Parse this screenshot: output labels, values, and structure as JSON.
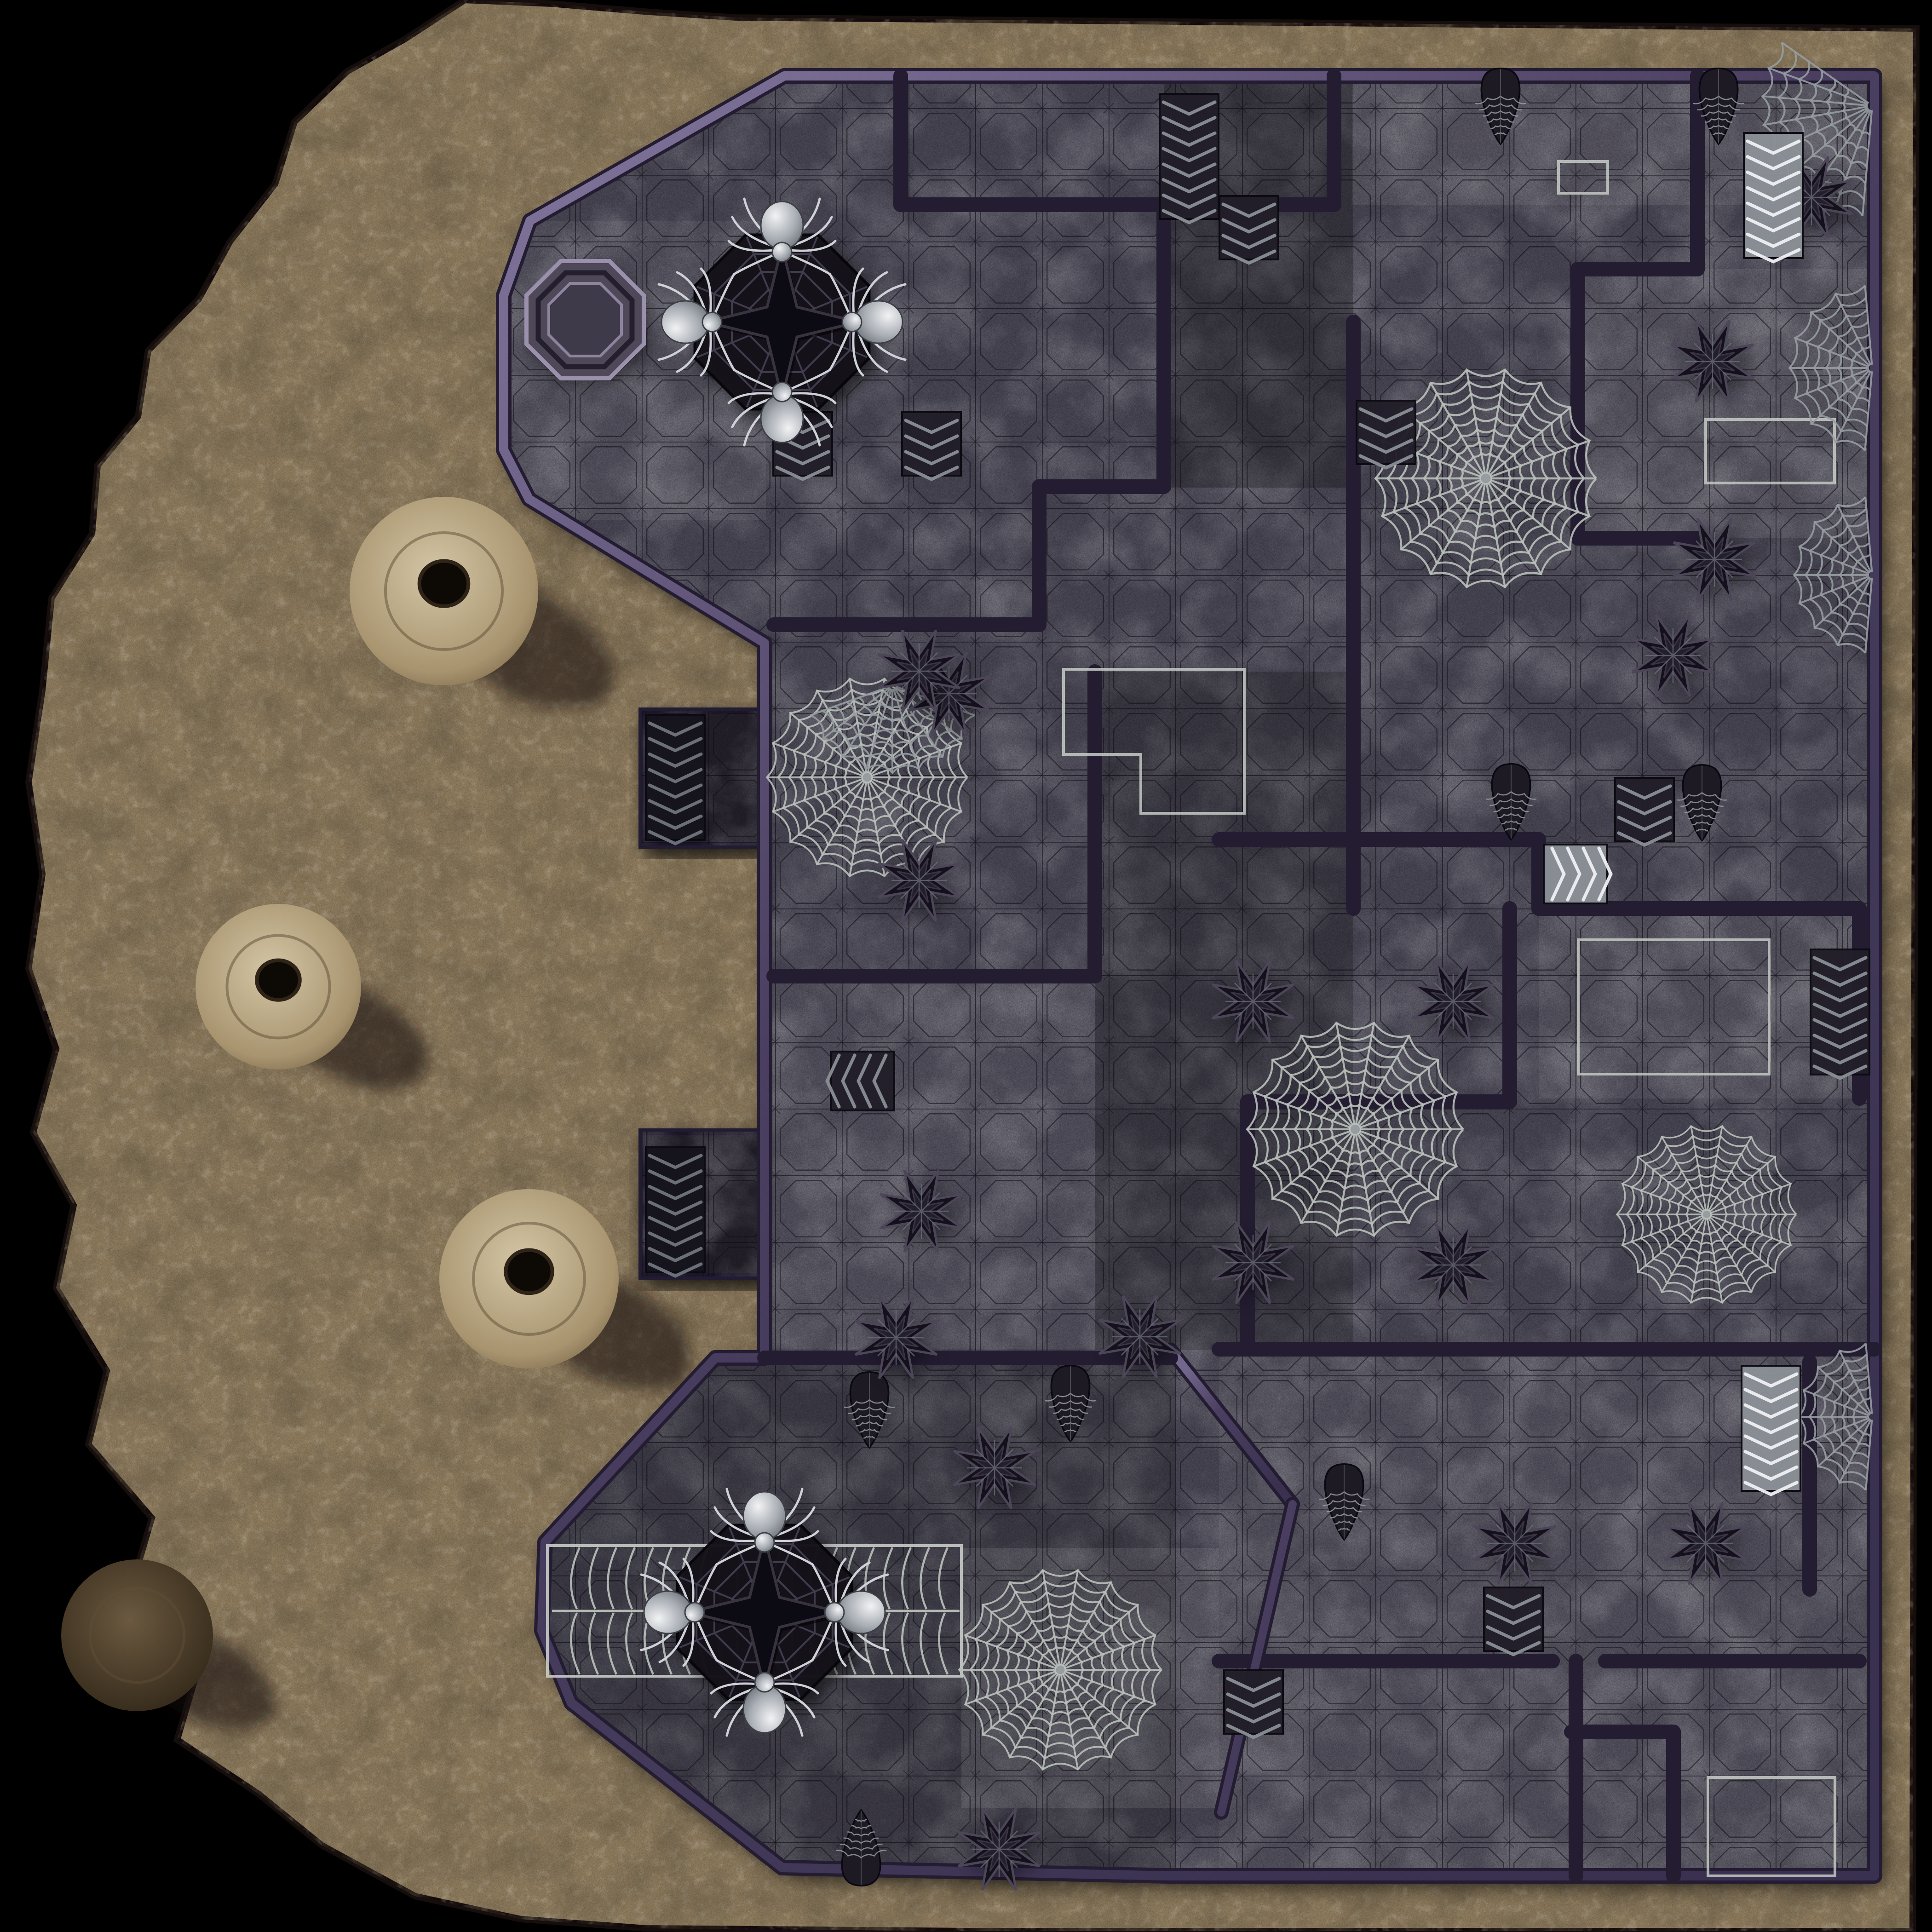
{
  "meta": {
    "name": "spider-dungeon-battle-map",
    "kind": "tabletop-battle-map"
  },
  "palette": {
    "bg": "#000000",
    "sand": "#a18c6a",
    "sandLight": "#d8c8a6",
    "sandDark": "#2e2314",
    "sandEdge": "#120d07",
    "floor": "#575263",
    "floorLight": "#746d7e",
    "floorDark": "#36323e",
    "wallDark": "#241d32",
    "wallMid": "#4a3f60",
    "wallSheenA": "#8478a0",
    "wallSheenB": "#3a3150",
    "grid": "#0d0a12",
    "tileCarve": "#14101c",
    "web": "#b9c0ba",
    "webDim": "#969ca0",
    "marker": "#c6cbc6",
    "spiderBody": "#dfe2e5",
    "spiderMid": "#a7acb3",
    "spiderDark": "#5c6168",
    "objectDark": "#14111b",
    "objectEdge": "#4c4658",
    "stairLightBase": "#8b9097",
    "stairLightRidge": "#eef0f3",
    "stairDarkBase": "#211e29",
    "stairDarkRidge": "#8a8f96",
    "stairBlackBase": "#15131c",
    "stairBlackRidge": "#6f747d",
    "wellRimLight": "#9b91ad",
    "wellRimDark": "#241f2e",
    "wellBasin": "#3f3a4a"
  },
  "grid": {
    "size": 145,
    "offset": 90
  },
  "cave": {
    "outline": [
      [
        1010,
        0
      ],
      [
        880,
        85
      ],
      [
        755,
        155
      ],
      [
        640,
        265
      ],
      [
        598,
        400
      ],
      [
        500,
        525
      ],
      [
        432,
        650
      ],
      [
        322,
        762
      ],
      [
        300,
        905
      ],
      [
        212,
        1012
      ],
      [
        200,
        1160
      ],
      [
        112,
        1300
      ],
      [
        92,
        1500
      ],
      [
        62,
        1700
      ],
      [
        92,
        1900
      ],
      [
        62,
        2105
      ],
      [
        122,
        2280
      ],
      [
        72,
        2462
      ],
      [
        160,
        2620
      ],
      [
        122,
        2800
      ],
      [
        232,
        2980
      ],
      [
        192,
        3140
      ],
      [
        330,
        3300
      ],
      [
        282,
        3462
      ],
      [
        432,
        3622
      ],
      [
        385,
        3782
      ],
      [
        562,
        3900
      ],
      [
        700,
        4012
      ],
      [
        902,
        4122
      ],
      [
        1132,
        4172
      ],
      [
        1402,
        4192
      ],
      [
        2100,
        4198
      ],
      [
        4158,
        4198
      ],
      [
        4166,
        62
      ],
      [
        1600,
        38
      ],
      [
        1400,
        25
      ],
      [
        1200,
        8
      ]
    ],
    "mounds": [
      {
        "x": 965,
        "y": 1285,
        "r": 205,
        "variant": "sand"
      },
      {
        "x": 605,
        "y": 2145,
        "r": 180,
        "variant": "sand"
      },
      {
        "x": 1150,
        "y": 2780,
        "r": 195,
        "variant": "sand"
      },
      {
        "x": 298,
        "y": 3555,
        "r": 165,
        "variant": "dark"
      }
    ]
  },
  "map": {
    "outline": [
      [
        1705,
        165
      ],
      [
        4075,
        165
      ],
      [
        4075,
        4078
      ],
      [
        2545,
        4078
      ],
      [
        1700,
        4060
      ],
      [
        1242,
        3702
      ],
      [
        1178,
        3545
      ],
      [
        1185,
        3352
      ],
      [
        1555,
        2952
      ],
      [
        1662,
        2952
      ],
      [
        1662,
        1398
      ],
      [
        1150,
        1085
      ],
      [
        1095,
        978
      ],
      [
        1095,
        642
      ],
      [
        1152,
        480
      ]
    ],
    "pads": [
      [
        1395,
        1545,
        268,
        293
      ],
      [
        1395,
        2460,
        268,
        315
      ]
    ],
    "walls": [
      [
        1958,
        165,
        1958,
        445
      ],
      [
        1958,
        445,
        2530,
        445
      ],
      [
        2530,
        445,
        2530,
        1058
      ],
      [
        2259,
        1058,
        2530,
        1058
      ],
      [
        2259,
        1058,
        2259,
        1358
      ],
      [
        1682,
        1358,
        2259,
        1358
      ],
      [
        2900,
        165,
        2900,
        445
      ],
      [
        2650,
        445,
        2900,
        445
      ],
      [
        2942,
        700,
        2942,
        1975
      ],
      [
        2650,
        1825,
        3345,
        1825
      ],
      [
        3345,
        1825,
        3345,
        1975
      ],
      [
        3345,
        1975,
        4042,
        1975
      ],
      [
        4042,
        1975,
        4042,
        2388
      ],
      [
        3282,
        1975,
        3282,
        2395
      ],
      [
        2712,
        2395,
        3282,
        2395
      ],
      [
        2712,
        2395,
        2712,
        2933
      ],
      [
        2380,
        1460,
        2380,
        2122
      ],
      [
        1682,
        2122,
        2380,
        2122
      ],
      [
        3430,
        585,
        3430,
        1170
      ],
      [
        3430,
        585,
        3690,
        585
      ],
      [
        3430,
        1170,
        3700,
        1170
      ],
      [
        3690,
        165,
        3690,
        585
      ],
      [
        2650,
        2933,
        4075,
        2933
      ],
      [
        2650,
        3611,
        3375,
        3611
      ],
      [
        3490,
        3611,
        4042,
        3611
      ],
      [
        3426,
        3611,
        3426,
        4078
      ],
      [
        3638,
        3765,
        3638,
        4078
      ],
      [
        3416,
        3765,
        3638,
        3765
      ],
      [
        3934,
        2960,
        3934,
        3455
      ],
      [
        2545,
        2935,
        2810,
        3270
      ],
      [
        2810,
        3270,
        2655,
        3940
      ],
      [
        1662,
        2952,
        2545,
        2952
      ]
    ],
    "shades": [
      [
        2530,
        165,
        412,
        895,
        "#000000",
        0.25
      ],
      [
        2380,
        1460,
        562,
        1475,
        "#000000",
        0.2
      ],
      [
        1175,
        2952,
        1380,
        1128,
        "#000000",
        0.16
      ],
      [
        2940,
        165,
        1130,
        280,
        "#ffffff",
        0.1
      ],
      [
        3430,
        585,
        640,
        585,
        "#ffffff",
        0.1
      ],
      [
        2090,
        3365,
        560,
        565,
        "#ffffff",
        0.12
      ],
      [
        2650,
        2933,
        1420,
        1148,
        "#ffffff",
        0.07
      ],
      [
        1095,
        480,
        570,
        650,
        "#ffffff",
        0.08
      ],
      [
        3345,
        1975,
        700,
        413,
        "#ffffff",
        0.09
      ],
      [
        1662,
        2122,
        718,
        810,
        "#ffffff",
        0.07
      ]
    ],
    "zones": {
      "rects": [
        [
          3708,
          912,
          280,
          138
        ],
        [
          3431,
          2043,
          415,
          292
        ],
        [
          3713,
          3864,
          276,
          214
        ],
        [
          3388,
          351,
          107,
          69
        ]
      ],
      "polys": [
        [
          [
            2312,
            1455
          ],
          [
            2705,
            1455
          ],
          [
            2705,
            1768
          ],
          [
            2480,
            1768
          ],
          [
            2480,
            1640
          ],
          [
            2312,
            1640
          ]
        ]
      ]
    },
    "radial_webs": [
      {
        "x": 3230,
        "y": 1040,
        "r": 240
      },
      {
        "x": 1885,
        "y": 1690,
        "r": 218
      },
      {
        "x": 2946,
        "y": 2455,
        "r": 235
      },
      {
        "x": 3710,
        "y": 2640,
        "r": 195
      },
      {
        "x": 2305,
        "y": 3630,
        "r": 220
      }
    ],
    "sector_webs": [
      {
        "x": 4070,
        "y": 230,
        "r": 240,
        "a0": 95,
        "a1": 215
      },
      {
        "x": 4070,
        "y": 800,
        "r": 180,
        "a0": 95,
        "a1": 265
      },
      {
        "x": 4070,
        "y": 1250,
        "r": 170,
        "a0": 95,
        "a1": 265
      },
      {
        "x": 4070,
        "y": 3080,
        "r": 160,
        "a0": 95,
        "a1": 265
      },
      {
        "x": 1940,
        "y": 1490,
        "r": 190,
        "a0": 20,
        "a1": 160
      }
    ],
    "cocoon_webs": [
      {
        "x": 3262,
        "y": 228,
        "rot": 0
      },
      {
        "x": 3736,
        "y": 228,
        "rot": 0
      },
      {
        "x": 3285,
        "y": 1740,
        "rot": 0
      },
      {
        "x": 3700,
        "y": 1742,
        "rot": 0
      },
      {
        "x": 1890,
        "y": 3062,
        "rot": 0
      },
      {
        "x": 2327,
        "y": 3048,
        "rot": 0
      },
      {
        "x": 2922,
        "y": 3262,
        "rot": 0
      },
      {
        "x": 1872,
        "y": 4020,
        "rot": 180
      }
    ],
    "star_spikes": [
      [
        2063,
        1508
      ],
      [
        3723,
        786
      ],
      [
        3727,
        1216
      ],
      [
        1998,
        1459
      ],
      [
        1998,
        1914
      ],
      [
        2003,
        2633
      ],
      [
        2724,
        2177
      ],
      [
        3159,
        2177
      ],
      [
        2724,
        2745
      ],
      [
        3159,
        2750
      ],
      [
        1948,
        2908
      ],
      [
        2478,
        2906
      ],
      [
        2162,
        3191
      ],
      [
        3293,
        3355
      ],
      [
        3708,
        3355
      ],
      [
        2172,
        4020
      ],
      [
        3938,
        429
      ],
      [
        3637,
        1425
      ]
    ],
    "stairs": [
      {
        "x": 2585,
        "y": 340,
        "rot": 0,
        "variant": "dark",
        "len": 2
      },
      {
        "x": 2715,
        "y": 495,
        "rot": 0,
        "variant": "dark",
        "len": 1
      },
      {
        "x": 1745,
        "y": 965,
        "rot": 0,
        "variant": "dark",
        "len": 1
      },
      {
        "x": 2025,
        "y": 965,
        "rot": 0,
        "variant": "dark",
        "len": 1
      },
      {
        "x": 3855,
        "y": 425,
        "rot": 0,
        "variant": "light",
        "len": 2
      },
      {
        "x": 1468,
        "y": 1690,
        "rot": 0,
        "variant": "black",
        "len": 2
      },
      {
        "x": 1468,
        "y": 2630,
        "rot": 0,
        "variant": "black",
        "len": 2
      },
      {
        "x": 1875,
        "y": 2350,
        "rot": 90,
        "variant": "dark",
        "len": 1
      },
      {
        "x": 3425,
        "y": 1900,
        "rot": 270,
        "variant": "light",
        "len": 1
      },
      {
        "x": 3575,
        "y": 1760,
        "rot": 0,
        "variant": "dark",
        "len": 1
      },
      {
        "x": 4000,
        "y": 2200,
        "rot": 0,
        "variant": "dark",
        "len": 2
      },
      {
        "x": 3850,
        "y": 3105,
        "rot": 0,
        "variant": "light",
        "len": 2
      },
      {
        "x": 2725,
        "y": 3700,
        "rot": 0,
        "variant": "dark",
        "len": 1
      },
      {
        "x": 3290,
        "y": 3520,
        "rot": 0,
        "variant": "dark",
        "len": 1
      },
      {
        "x": 3013,
        "y": 940,
        "rot": 0,
        "variant": "dark",
        "len": 1
      }
    ],
    "well": {
      "x": 1272,
      "y": 695,
      "r": 138
    },
    "spider_emblems": [
      {
        "x": 1700,
        "y": 700
      },
      {
        "x": 1662,
        "y": 3505
      }
    ],
    "web_band": {
      "x1": 1190,
      "x2": 2090,
      "y": 3502,
      "half": 142
    }
  }
}
